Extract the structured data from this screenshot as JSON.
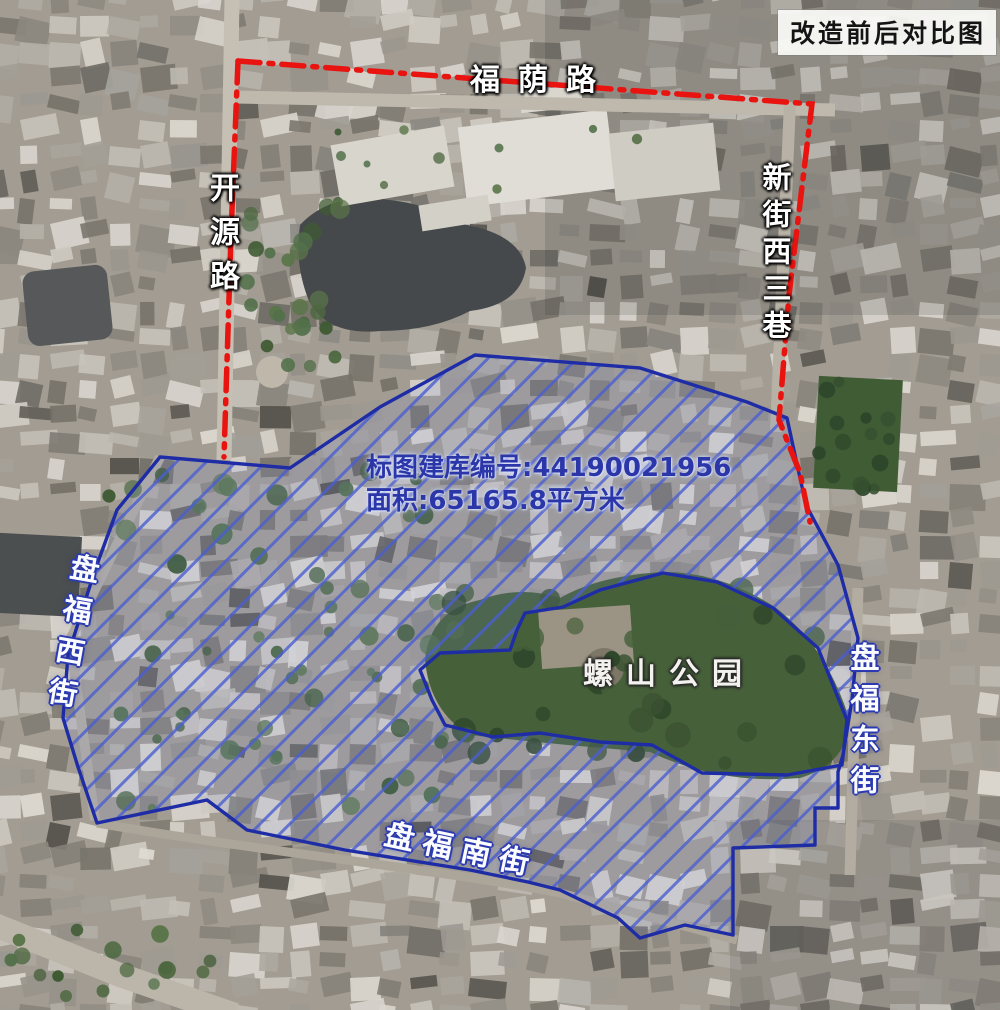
{
  "title_badge": "改造前后对比图",
  "annotation": {
    "line1": "标图建库编号:44190021956",
    "line2": "面积:65165.8平方米"
  },
  "labels": {
    "fuyin_road": "福荫路",
    "kaiyuan_road": "开源路",
    "xinjie_west_3_lane": "新街西三巷",
    "panfu_west_street": "盘福西街",
    "panfu_east_street": "盘福东街",
    "panfu_south_street": "盘福南街",
    "luoshan_park": "螺山公园"
  },
  "zone": {
    "outline_color": "#1e2ca6",
    "hatch_color": "#4a5ed0",
    "fill_tint": "rgba(125,145,235,0.12)",
    "outer_points": [
      [
        475,
        355
      ],
      [
        640,
        368
      ],
      [
        747,
        402
      ],
      [
        787,
        418
      ],
      [
        795,
        455
      ],
      [
        806,
        505
      ],
      [
        838,
        565
      ],
      [
        858,
        638
      ],
      [
        852,
        700
      ],
      [
        843,
        755
      ],
      [
        838,
        772
      ],
      [
        838,
        808
      ],
      [
        815,
        808
      ],
      [
        815,
        845
      ],
      [
        733,
        848
      ],
      [
        733,
        935
      ],
      [
        685,
        925
      ],
      [
        640,
        938
      ],
      [
        618,
        918
      ],
      [
        560,
        890
      ],
      [
        528,
        882
      ],
      [
        470,
        870
      ],
      [
        345,
        850
      ],
      [
        247,
        830
      ],
      [
        207,
        800
      ],
      [
        97,
        823
      ],
      [
        78,
        767
      ],
      [
        63,
        718
      ],
      [
        68,
        655
      ],
      [
        95,
        570
      ],
      [
        117,
        510
      ],
      [
        160,
        457
      ],
      [
        290,
        468
      ],
      [
        380,
        407
      ]
    ],
    "hole_points": [
      [
        563,
        607
      ],
      [
        600,
        590
      ],
      [
        663,
        573
      ],
      [
        717,
        582
      ],
      [
        773,
        608
      ],
      [
        818,
        648
      ],
      [
        847,
        720
      ],
      [
        842,
        765
      ],
      [
        787,
        775
      ],
      [
        702,
        773
      ],
      [
        652,
        745
      ],
      [
        600,
        742
      ],
      [
        540,
        733
      ],
      [
        493,
        737
      ],
      [
        445,
        725
      ],
      [
        432,
        700
      ],
      [
        420,
        670
      ],
      [
        440,
        653
      ],
      [
        510,
        650
      ],
      [
        517,
        630
      ],
      [
        525,
        613
      ]
    ]
  },
  "red_boundary": {
    "color": "#e91310",
    "dash": "22 9 4 9",
    "paths": [
      [
        [
          238,
          61
        ],
        [
          812,
          104
        ],
        [
          789,
          295
        ],
        [
          779,
          420
        ],
        [
          800,
          473
        ],
        [
          810,
          522
        ]
      ],
      [
        [
          238,
          61
        ],
        [
          231,
          235
        ],
        [
          224,
          457
        ]
      ]
    ]
  }
}
